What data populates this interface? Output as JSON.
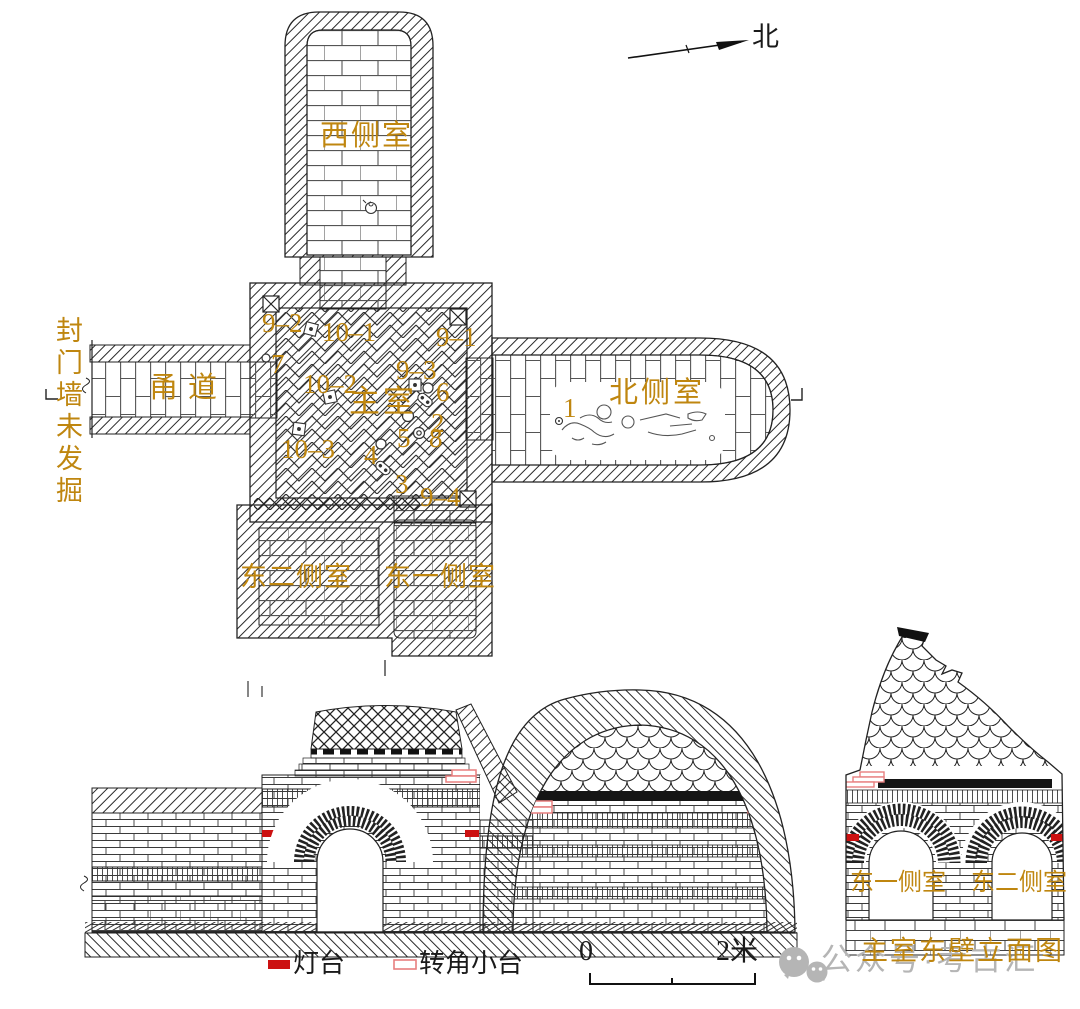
{
  "colors": {
    "label": "#bf860f",
    "lamp_red": "#cc1111",
    "corner_pink": "#e87f7f",
    "watermark_gray": "#b5b5b5",
    "line": "#1a1a1a"
  },
  "compass": {
    "north_label": "北"
  },
  "plan": {
    "west_chamber_label": "西侧室",
    "corridor_label": "甬道",
    "seal_wall_note": "封门墙未发掘",
    "main_chamber_label": "主室",
    "north_chamber_label": "北侧室",
    "east_chamber_2_label": "东二侧室",
    "east_chamber_1_label": "东一侧室",
    "finds": {
      "f9_2": "9–2",
      "f10_1": "10–1",
      "f9_1": "9–1",
      "f7": "7",
      "f10_2": "10–2",
      "f9_3": "9–3",
      "f6": "6",
      "f2": "2",
      "f5": "5",
      "f8": "8",
      "f10_3": "10–3",
      "f4": "4",
      "f3": "3",
      "f9_4": "9–4",
      "f1": "1"
    }
  },
  "elevation": {
    "east_chamber_1_label": "东一侧室",
    "east_chamber_2_label": "东二侧室",
    "caption": "主室东壁立面图"
  },
  "legend": {
    "lamp_label": "灯台",
    "corner_platform_label": "转角小台"
  },
  "scale_bar": {
    "start": "0",
    "end": "2米"
  },
  "watermark": {
    "text": "公众号·考古汇"
  }
}
